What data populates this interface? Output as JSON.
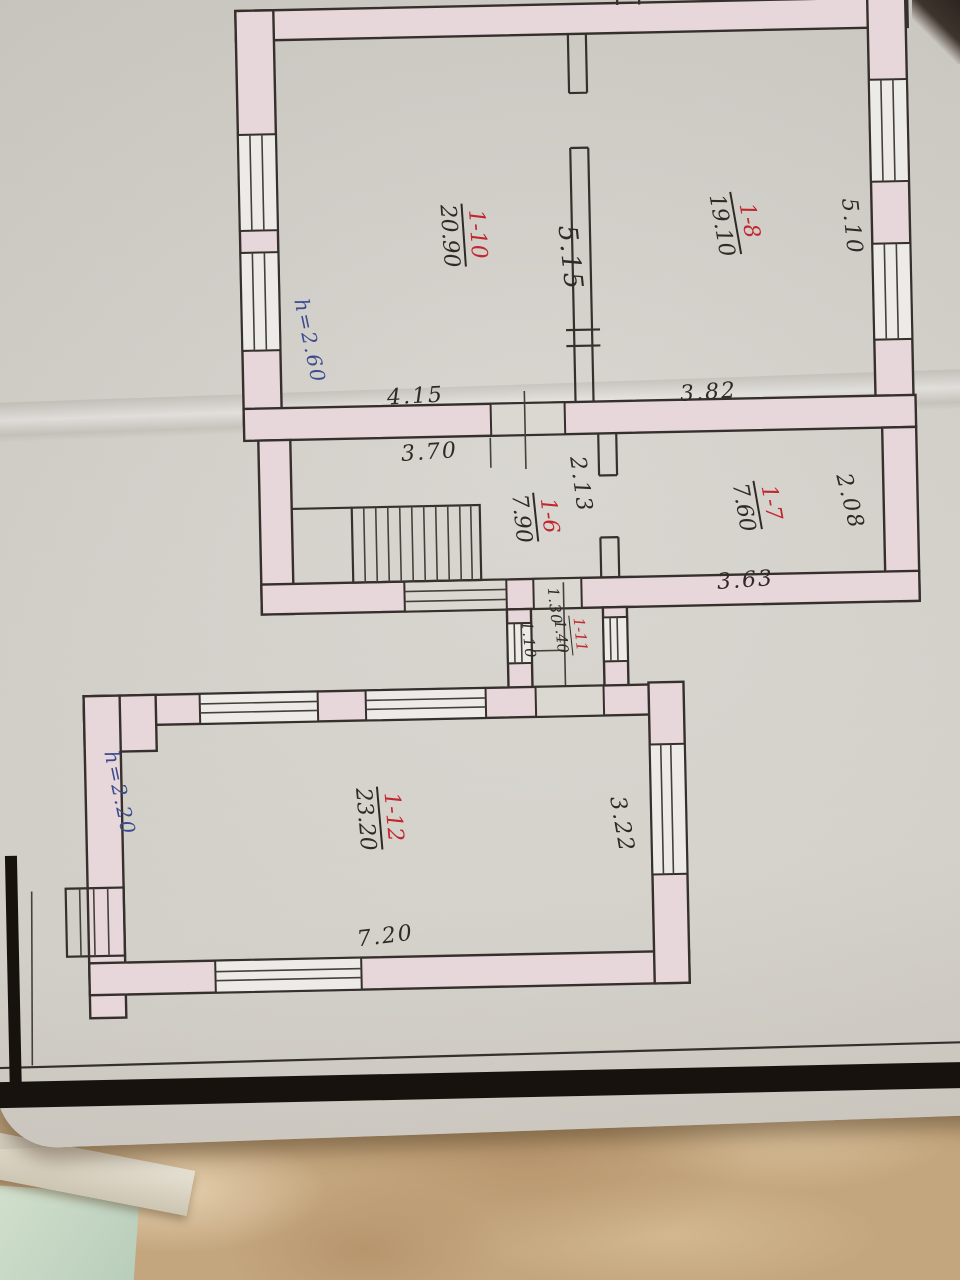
{
  "plan": {
    "rooms": [
      {
        "number": "1-10",
        "area": "20.90"
      },
      {
        "number": "1-8",
        "area": "19.10"
      },
      {
        "number": "1-6",
        "area": "7.90"
      },
      {
        "number": "1-7",
        "area": "7.60"
      },
      {
        "number": "1-11",
        "area": "1.40"
      },
      {
        "number": "1-12",
        "area": "23.20"
      }
    ],
    "dims": {
      "v515": "5.15",
      "v510": "5.10",
      "h415": "4.15",
      "h382": "3.82",
      "h370": "3.70",
      "v213": "2.13",
      "v208": "2.08",
      "h363": "3.63",
      "v130": "1.30",
      "v110": "1.10",
      "v322": "3.22",
      "h720": "7.20"
    },
    "heights": {
      "upper": "h=2.60",
      "lower": "h=2.20"
    },
    "colors": {
      "wall_fill": "#e7d6da",
      "line": "#35302c",
      "room_number_red": "#c1272d",
      "handwriting_blue": "#3b4c8e",
      "paper": "#d6d3cd",
      "table": "#c4a67e"
    }
  }
}
